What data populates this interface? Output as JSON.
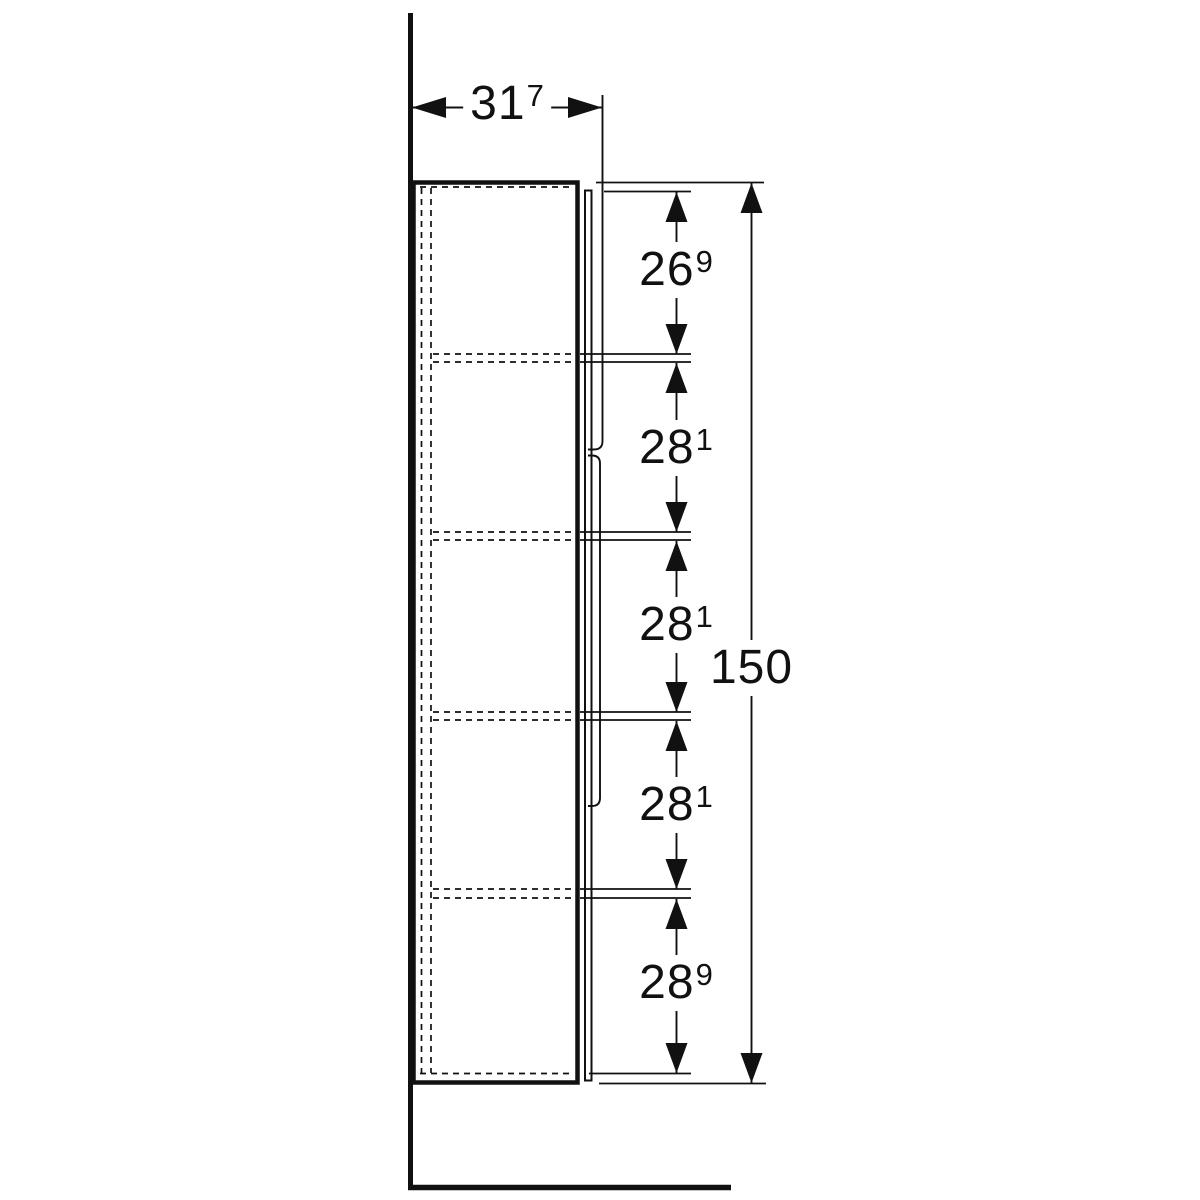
{
  "drawing": {
    "kind": "technical dimension drawing",
    "view": "side elevation of a tall wall-standing cabinet with four internal shelves (dashed), front door with recessed grip, wall at left and floor at bottom",
    "units_note": "dimensions in cm with raised mm digit",
    "colors": {
      "line": "#111111",
      "background": "#ffffff"
    },
    "dimensions": {
      "depth": {
        "value": "31",
        "sup": "7",
        "display": "31.7"
      },
      "overall_height": {
        "value": "150",
        "sup": "",
        "display": "150"
      },
      "segments": [
        {
          "value": "26",
          "sup": "9",
          "display": "26.9",
          "position": "top compartment"
        },
        {
          "value": "28",
          "sup": "1",
          "display": "28.1",
          "position": "second compartment"
        },
        {
          "value": "28",
          "sup": "1",
          "display": "28.1",
          "position": "third compartment"
        },
        {
          "value": "28",
          "sup": "1",
          "display": "28.1",
          "position": "fourth compartment"
        },
        {
          "value": "28",
          "sup": "9",
          "display": "28.9",
          "position": "bottom compartment"
        }
      ]
    }
  }
}
